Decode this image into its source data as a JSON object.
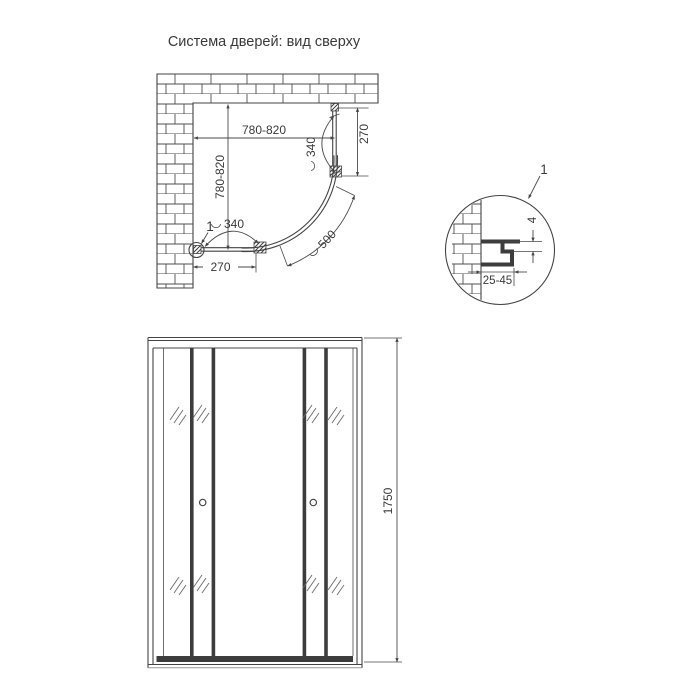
{
  "title": "Система дверей: вид сверху",
  "colors": {
    "line": "#444444",
    "text": "#3a3a3a",
    "background": "#ffffff"
  },
  "top_view": {
    "dim_width": "780-820",
    "dim_height": "780-820",
    "dim_door_top": "340",
    "dim_door_bottom": "340",
    "dim_offset_top": "270",
    "dim_offset_bottom": "270",
    "dim_radius": "500",
    "callout": "1"
  },
  "detail_view": {
    "callout": "1",
    "dim_gap": "4",
    "dim_range": "25-45"
  },
  "front_view": {
    "dim_height": "1750"
  }
}
